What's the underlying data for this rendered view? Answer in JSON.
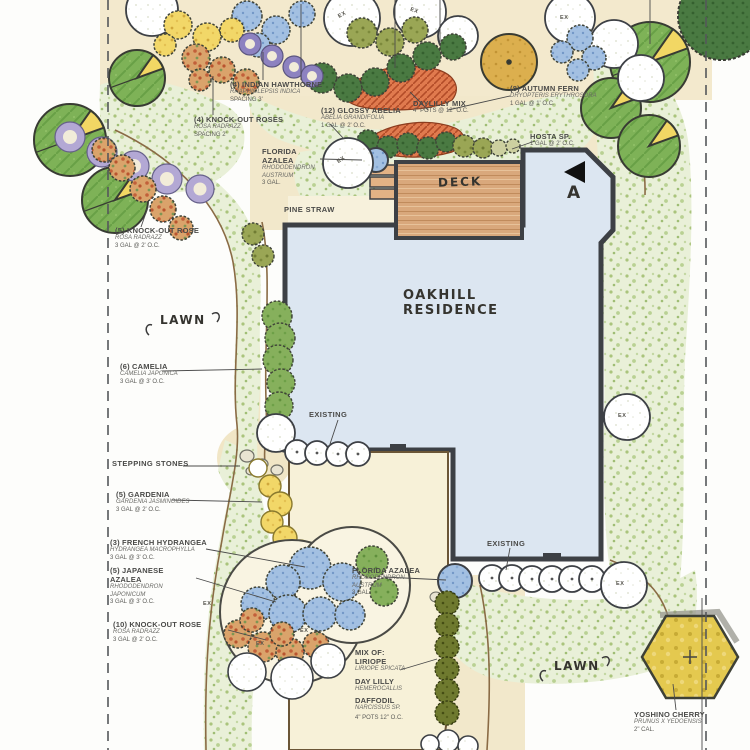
{
  "title": "Oakhill Residence landscape plan",
  "colors": {
    "paper": "#fdfdfb",
    "house": "#dce6f1",
    "wall": "#3d4045",
    "deck": "#d9a87c",
    "patio": "#f7f1d8",
    "bed_tan": "#f3e9cd",
    "edge_brown": "#8a6b45",
    "canopy_green": "#7eb257",
    "shrub_olive": "#9aa655",
    "azalea_blue": "#a3c0e2",
    "rose_orange": "#daa36b",
    "daylily_orange": "#e07a4e",
    "gardenia_yellow": "#f2d768",
    "cherry_yellow": "#e4c94f"
  },
  "residence": {
    "line1": "OAKHILL",
    "line2": "RESIDENCE"
  },
  "annotations": {
    "deck": "DECK",
    "pine_straw": "PINE STRAW",
    "lawn": "LAWN",
    "stepping_stones": "STEPPING STONES",
    "existing": "EXISTING"
  },
  "markers": {
    "ex": "EX",
    "section_label": "A"
  },
  "plant_labels": [
    {
      "name": "(4) INDIAN HAWTHORNE",
      "botanical": "RHAPHIOLEPSIS INDICA",
      "spec": "SPACING 3'"
    },
    {
      "name": "(4) KNOCK-OUT ROSES",
      "botanical": "ROSA RADRAZZ",
      "spec": "SPACING 2'"
    },
    {
      "name": "(12) GLOSSY ABELIA",
      "botanical": "ABELIA GRANDIFOLIA",
      "spec": "1 GAL @ 2' O.C."
    },
    {
      "name": "DAYLILLY MIX",
      "botanical": "",
      "spec": "4\" POTS @ 12\" O.C."
    },
    {
      "name": "(8) AUTUMN FERN",
      "botanical": "DRYOPTERIS ERYTHROSORA",
      "spec": "1 GAL @ 1' O.C."
    },
    {
      "name": "HOSTA SP.",
      "botanical": "",
      "spec": "1 GAL @ 2' O.C."
    },
    {
      "name": "FLORIDA AZALEA",
      "botanical": "RHODODENDRON AUSTRIUM",
      "spec": "3 GAL."
    },
    {
      "name": "(5) KNOCK-OUT ROSE",
      "botanical": "ROSA RADRAZZ",
      "spec": "3 GAL @ 2' O.C."
    },
    {
      "name": "(6) CAMELIA",
      "botanical": "CAMELIA JAPONICA",
      "spec": "3 GAL @ 3' O.C."
    },
    {
      "name": "(5) GARDENIA",
      "botanical": "GARDENIA JASMINOIDES",
      "spec": "3 GAL @ 2' O.C."
    },
    {
      "name": "(3) FRENCH HYDRANGEA",
      "botanical": "HYDRANGEA MACROPHYLLA",
      "spec": "3 GAL @ 3' O.C."
    },
    {
      "name": "(5) JAPANESE AZALEA",
      "botanical": "RHODODENDRON JAPONICUM",
      "spec": "3 GAL @ 3' O.C."
    },
    {
      "name": "(10) KNOCK-OUT ROSE",
      "botanical": "ROSA RADRAZZ",
      "spec": "3 GAL @ 2' O.C."
    },
    {
      "name": "FLORIDA AZALEA",
      "botanical": "RHODODENDRON AUSTRUM",
      "spec": "3 GAL"
    },
    {
      "name": "YOSHINO CHERRY",
      "botanical": "PRUNUS X YEDOENSIS",
      "spec": "2\" CAL."
    }
  ],
  "mix_label": {
    "header": "MIX OF:",
    "items": [
      {
        "name": "LIRIOPE",
        "botanical": "LIRIOPE SPICATA"
      },
      {
        "name": "DAY LILLY",
        "botanical": "HEMEROCALLIS"
      },
      {
        "name": "DAFFODIL",
        "botanical": "NARCISSUS SP."
      }
    ],
    "spec": "4\" POTS 12\" O.C."
  }
}
